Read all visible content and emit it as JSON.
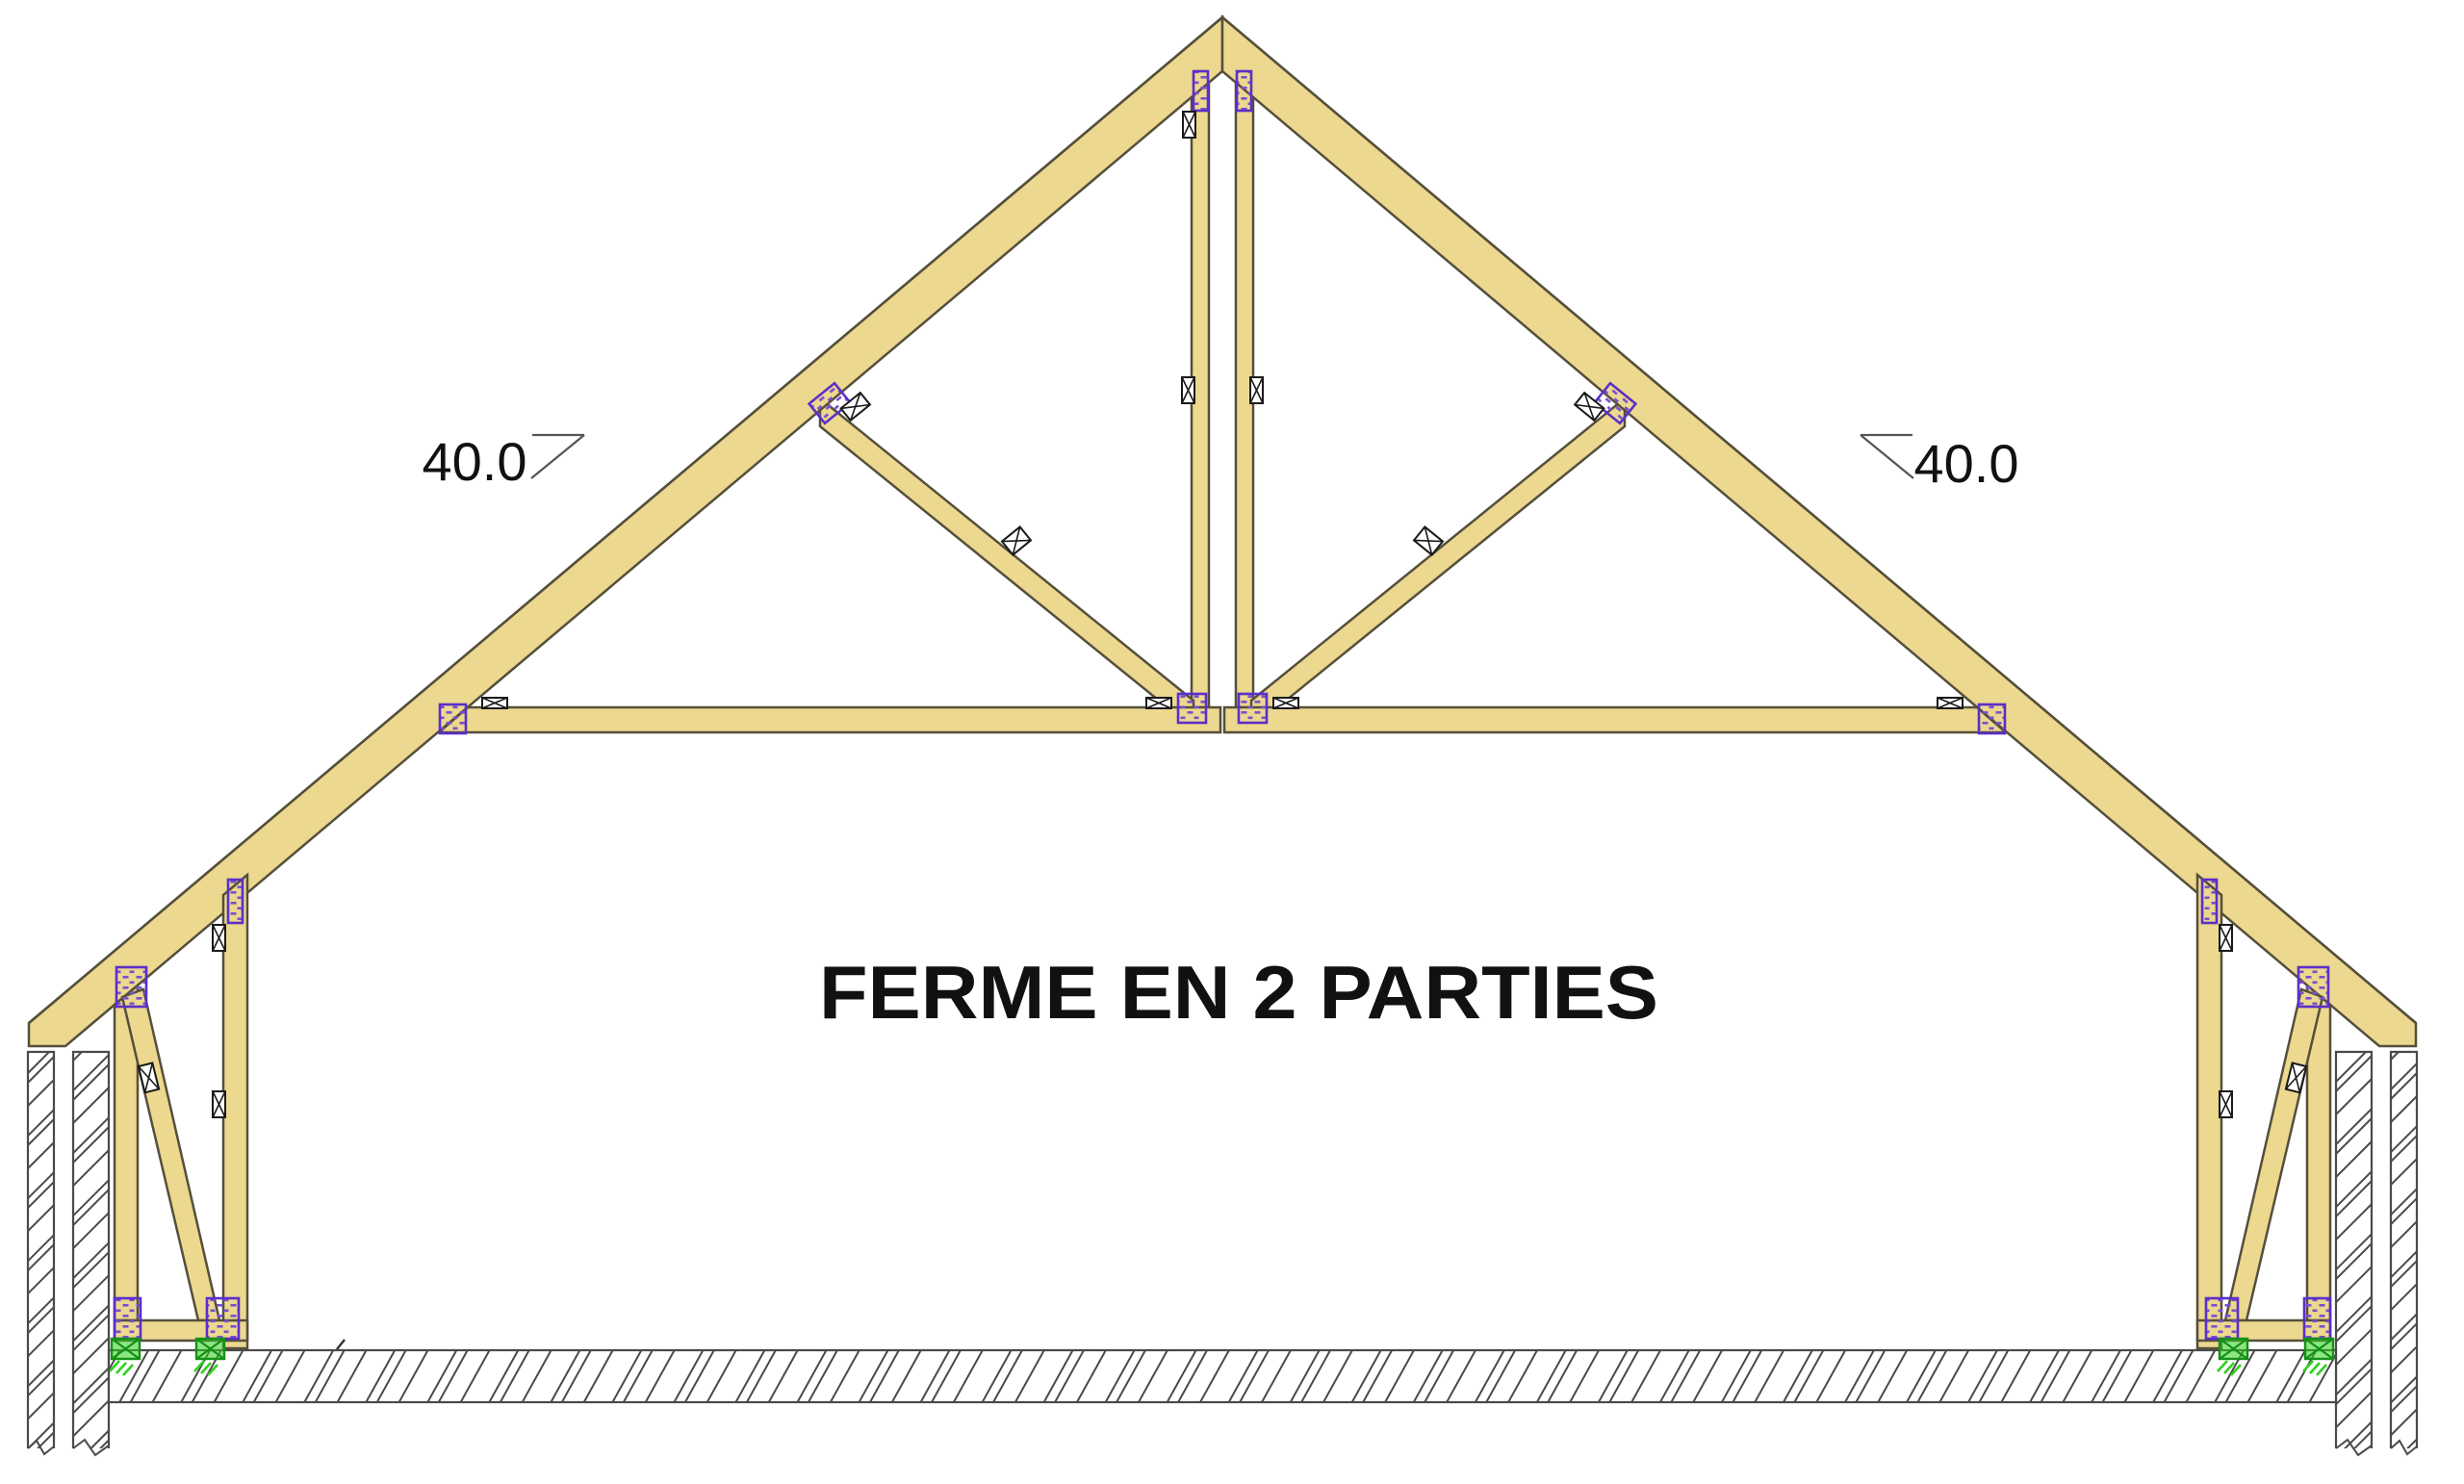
{
  "title": {
    "text": "FERME EN 2 PARTIES"
  },
  "annotations": {
    "left_slope": {
      "value": "40.0",
      "unit": "degrees"
    },
    "right_slope": {
      "value": "40.0",
      "unit": "degrees"
    }
  },
  "colors": {
    "timber_fill": "#ECD88E",
    "timber_outline": "#554F3C",
    "plate_purple": "#5B2FC8",
    "plate_dash": "#7A4FD0",
    "connector_black": "#1A1A1A",
    "support_green": "#2FD01F",
    "support_green_dark": "#149114",
    "hatch_gray": "#4A4A4A",
    "text_black": "#111111",
    "background": "#FFFFFF"
  },
  "components": [
    "left-rafter",
    "right-rafter",
    "left-king-post",
    "right-king-post",
    "left-strut",
    "right-strut",
    "left-tie-beam",
    "right-tie-beam",
    "left-wall-tall-post",
    "left-wall-short-post",
    "left-wall-brace",
    "left-sole-plate",
    "right-wall-tall-post",
    "right-wall-short-post",
    "right-wall-brace",
    "right-sole-plate",
    "left-masonry-wall",
    "right-masonry-wall",
    "floor-slab",
    "purple-connector-plates",
    "bolt-connectors",
    "green-supports"
  ]
}
